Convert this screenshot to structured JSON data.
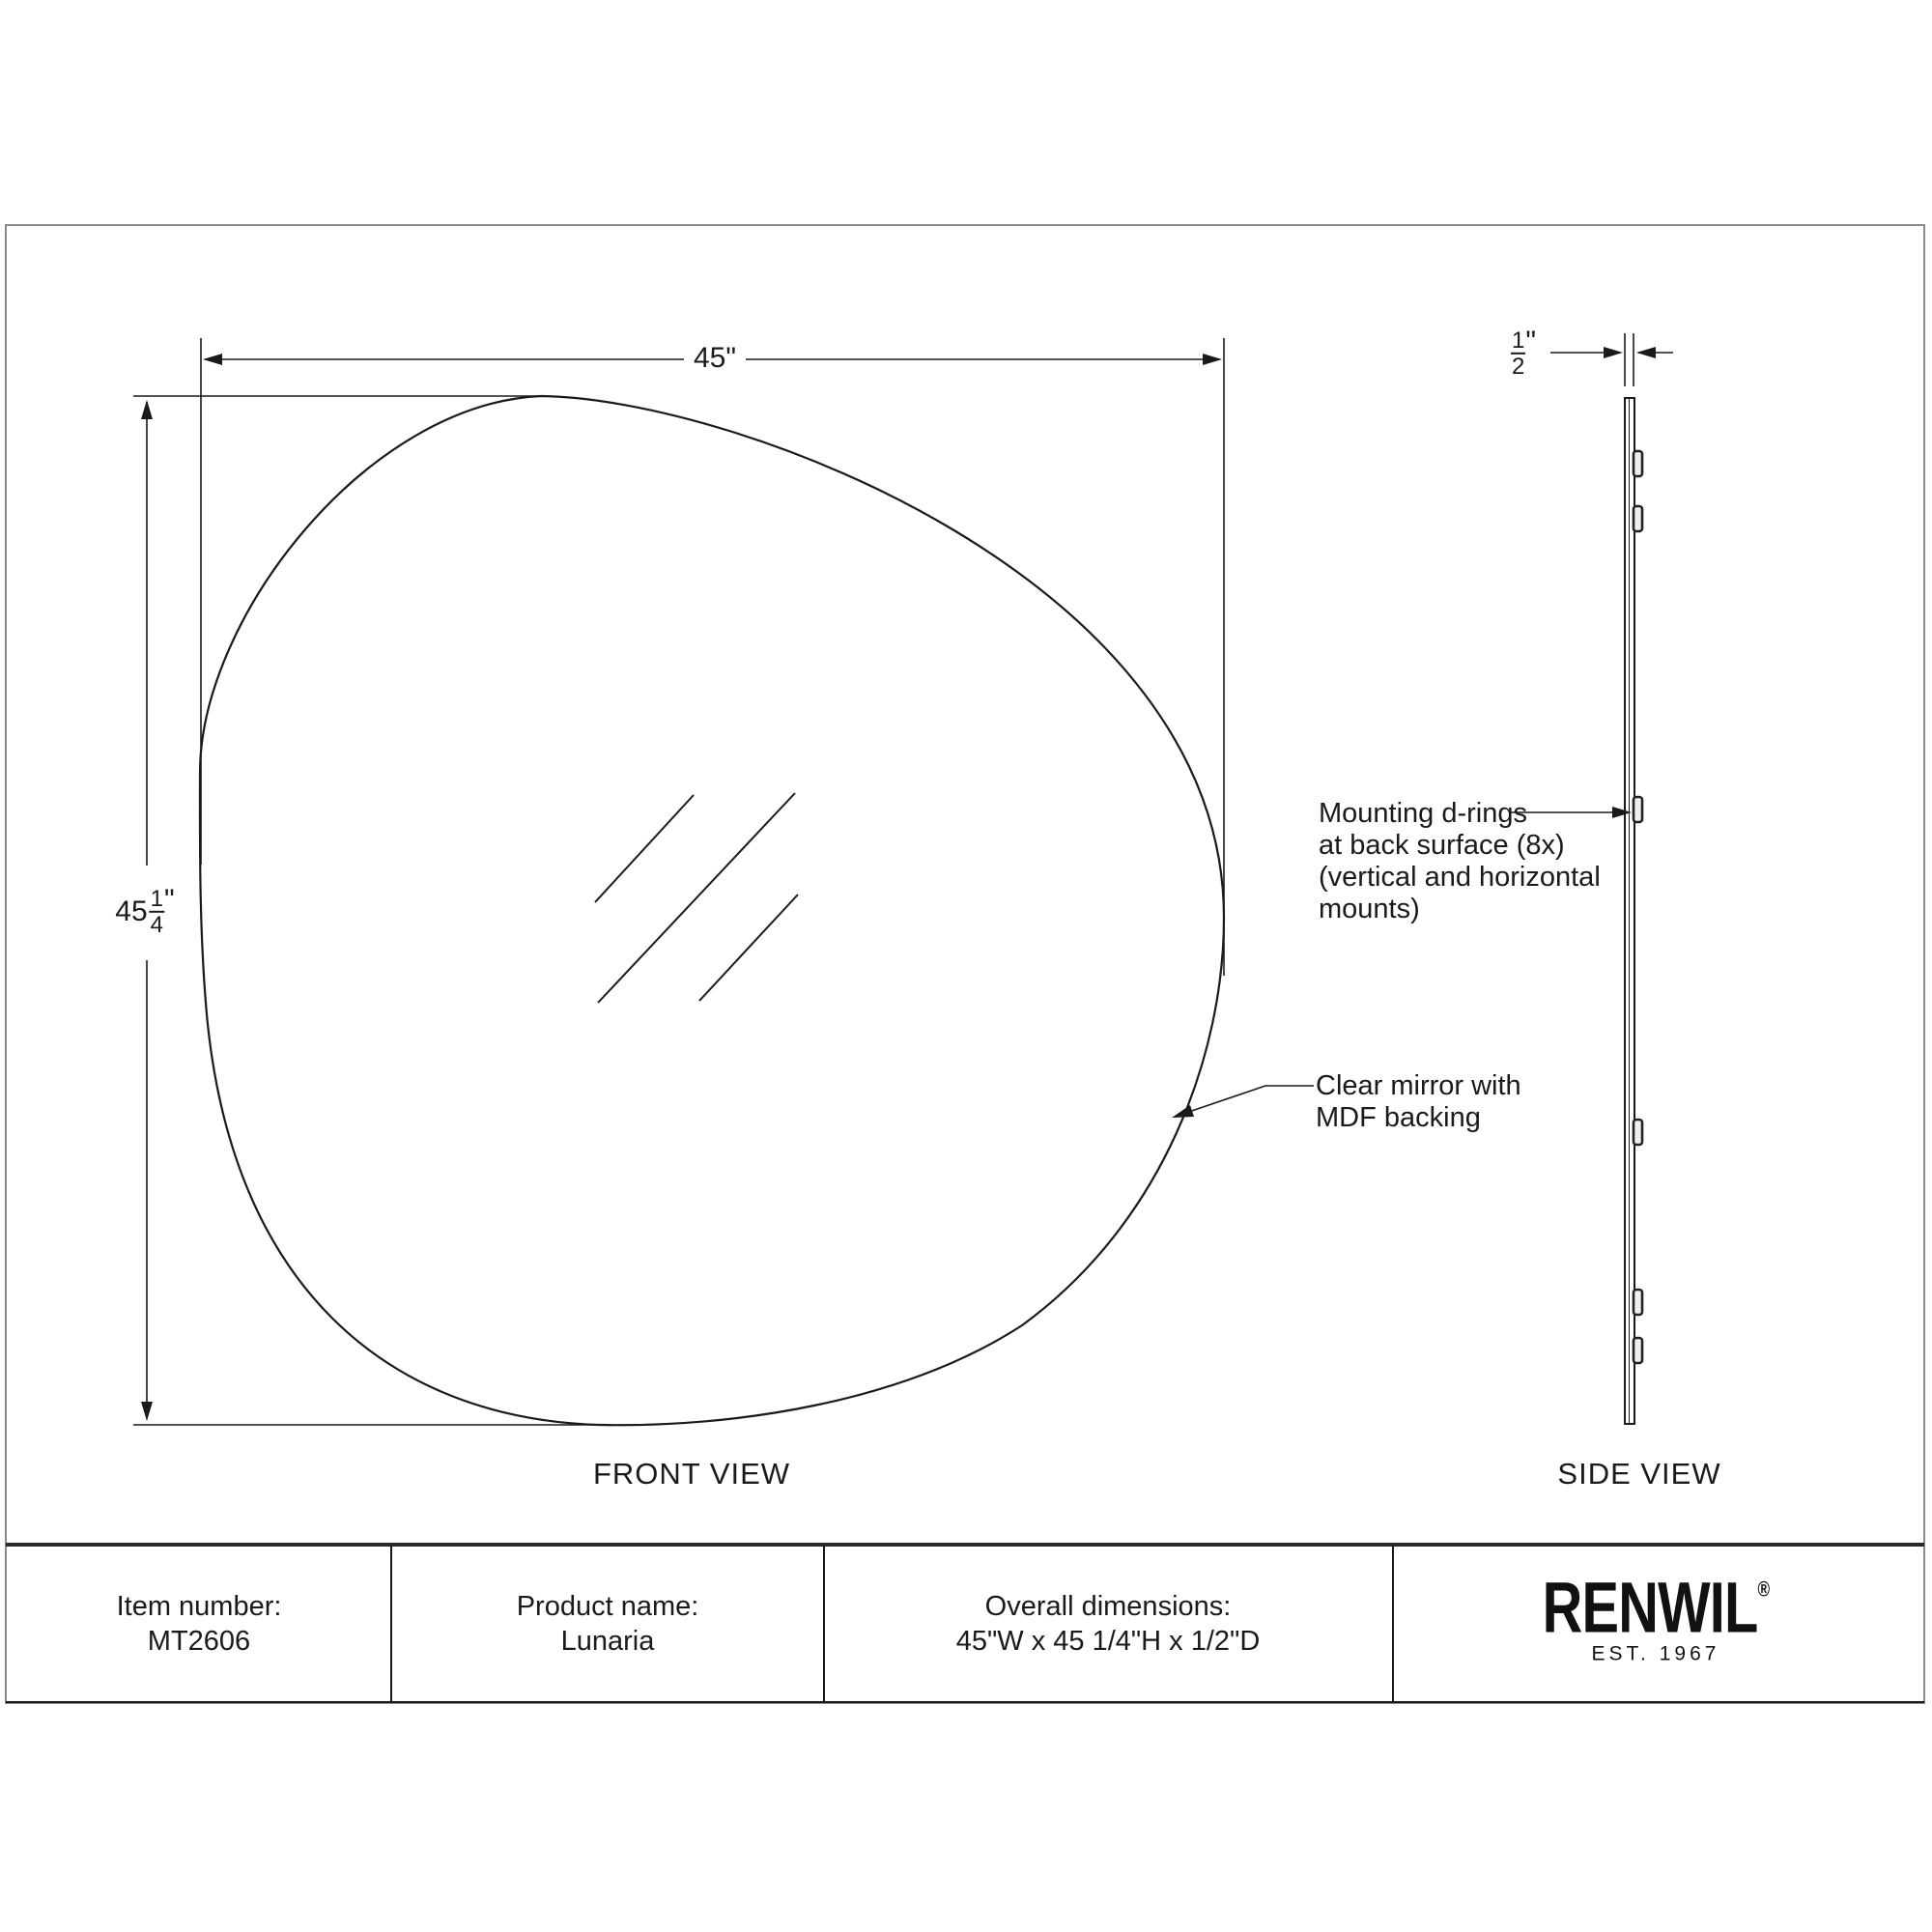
{
  "front_view": {
    "label": "FRONT VIEW",
    "width_dim_label": "45\"",
    "height_dim": {
      "whole": "45",
      "numerator": "1",
      "denominator": "4",
      "unit": "\""
    },
    "mirror_annotation": {
      "line1": "Clear mirror with",
      "line2": "MDF backing"
    }
  },
  "side_view": {
    "label": "SIDE VIEW",
    "depth_dim": {
      "numerator": "1",
      "denominator": "2",
      "unit": "\""
    },
    "drings_annotation": {
      "line1": "Mounting d-rings",
      "line2": "at back surface (8x)",
      "line3": "(vertical and horizontal",
      "line4": "mounts)"
    }
  },
  "spec_table": {
    "item": {
      "label": "Item number:",
      "value": "MT2606"
    },
    "product": {
      "label": "Product name:",
      "value": "Lunaria"
    },
    "dimensions": {
      "label": "Overall dimensions:",
      "value": "45\"W x 45 1/4\"H x 1/2\"D"
    },
    "brand": {
      "name": "RENWIL",
      "registered": "®",
      "established": "EST. 1967"
    }
  },
  "colors": {
    "line": "#1a1a1a",
    "frame": "#8a8a8a",
    "background": "#ffffff"
  }
}
